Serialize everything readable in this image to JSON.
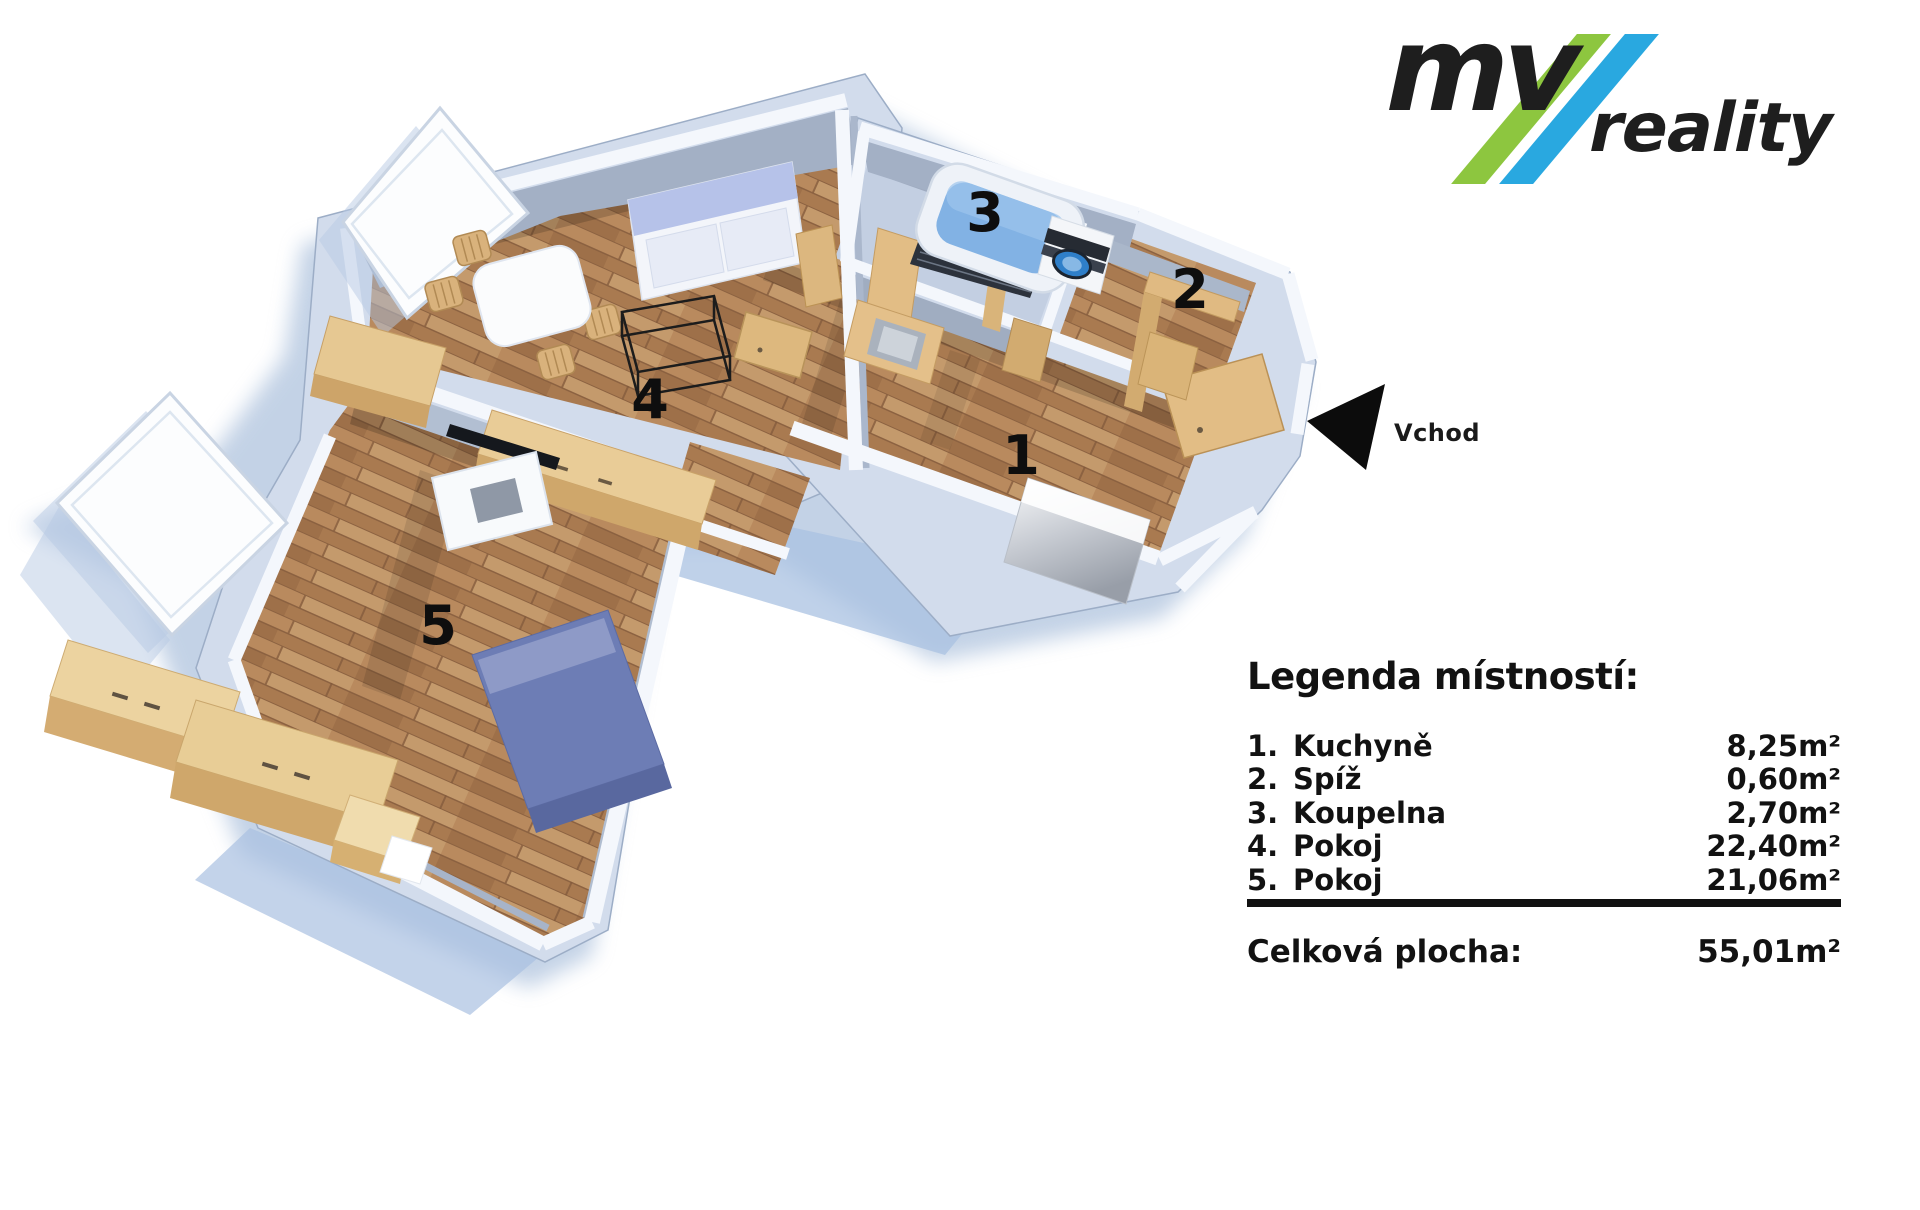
{
  "brand": {
    "name_part1": "mv",
    "name_part2": "reality",
    "stripe_colors": [
      "#8dc63f",
      "#29a8e0"
    ],
    "text_color": "#1e1e1e"
  },
  "entrance": {
    "label": "Vchod"
  },
  "floor_plan": {
    "room_labels": [
      "1",
      "2",
      "3",
      "4",
      "5"
    ]
  },
  "legend": {
    "title": "Legenda místností:",
    "rooms": [
      {
        "id": "1",
        "list_label": "1.",
        "name": "Kuchyně",
        "area": "8,25m²"
      },
      {
        "id": "2",
        "list_label": "2.",
        "name": "Spíž",
        "area": "0,60m²"
      },
      {
        "id": "3",
        "list_label": "3.",
        "name": "Koupelna",
        "area": "2,70m²"
      },
      {
        "id": "4",
        "list_label": "4.",
        "name": "Pokoj",
        "area": "22,40m²"
      },
      {
        "id": "5",
        "list_label": "5.",
        "name": "Pokoj",
        "area": "21,06m²"
      }
    ],
    "total_label": "Celková plocha:",
    "total_value": "55,01m²"
  }
}
